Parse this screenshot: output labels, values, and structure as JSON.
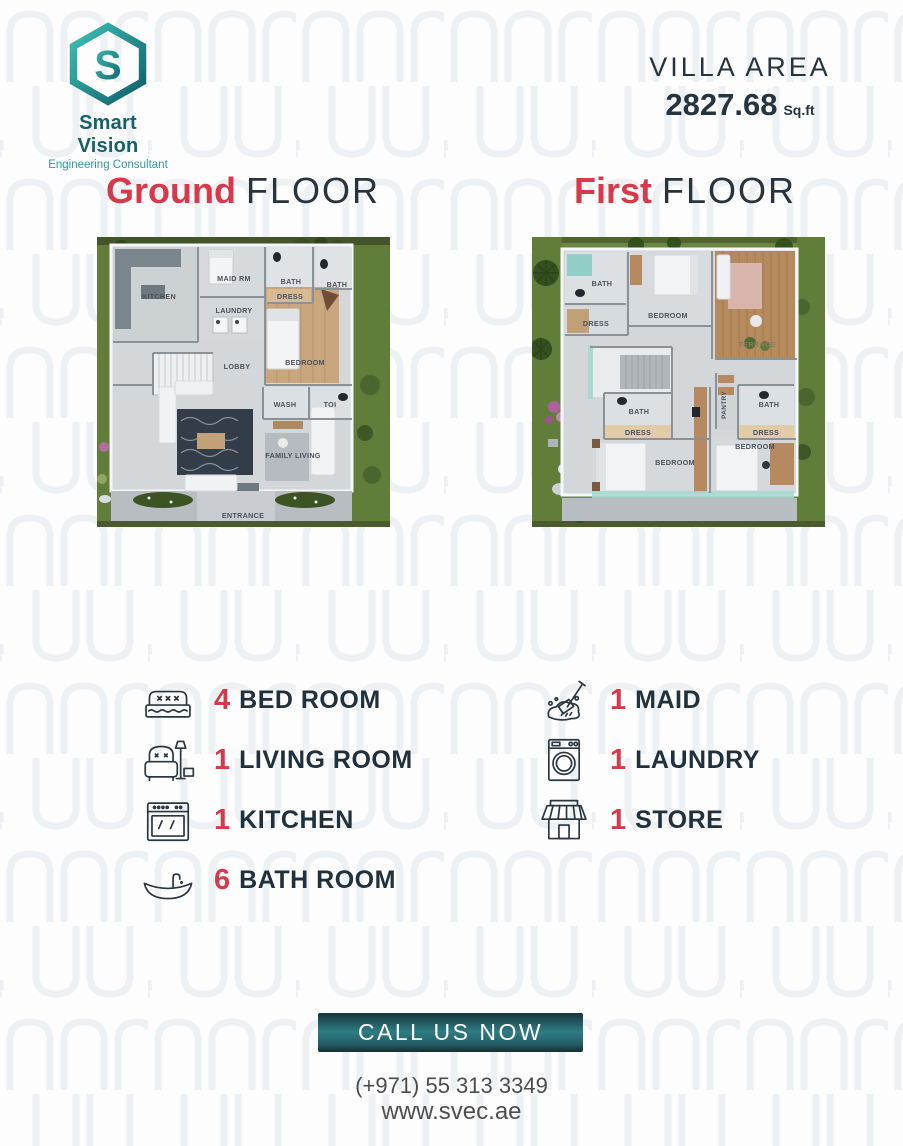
{
  "brand": {
    "name": "Smart Vision",
    "tagline": "Engineering Consultant",
    "mark_letter": "S"
  },
  "villa_area": {
    "label": "VILLA AREA",
    "value": "2827.68",
    "unit": "Sq.ft"
  },
  "floors": {
    "ground": {
      "title_accent": "Ground",
      "title_rest": "FLOOR",
      "labels": [
        "KITCHEN",
        "MAID RM",
        "BATH",
        "BATH",
        "DRESS",
        "LAUNDRY",
        "LOBBY",
        "BEDROOM",
        "WASH",
        "TOI",
        "FAMILY LIVING",
        "ENTRANCE"
      ]
    },
    "first": {
      "title_accent": "First",
      "title_rest": "FLOOR",
      "labels": [
        "BATH",
        "BEDROOM",
        "DRESS",
        "TERRACE",
        "BATH",
        "DRESS",
        "BEDROOM",
        "PANTRY",
        "BATH",
        "DRESS",
        "BEDROOM"
      ]
    }
  },
  "amenities": {
    "left": [
      {
        "count": "4",
        "label": "BED ROOM",
        "icon": "bed-icon"
      },
      {
        "count": "1",
        "label": "LIVING ROOM",
        "icon": "armchair-icon"
      },
      {
        "count": "1",
        "label": "KITCHEN",
        "icon": "stove-icon"
      },
      {
        "count": "6",
        "label": "BATH ROOM",
        "icon": "bathtub-icon"
      }
    ],
    "right": [
      {
        "count": "1",
        "label": "MAID",
        "icon": "mop-icon"
      },
      {
        "count": "1",
        "label": "LAUNDRY",
        "icon": "washing-machine-icon"
      },
      {
        "count": "1",
        "label": "STORE",
        "icon": "storefront-icon"
      }
    ]
  },
  "cta": {
    "button_label": "CALL US NOW",
    "phone": "(+971) 55 313 3349",
    "website": "www.svec.ae"
  },
  "colors": {
    "accent_red": "#d7384a",
    "heading_navy": "#27333d",
    "brand_teal_dark": "#0e5f68",
    "brand_teal_light": "#3ec0b4",
    "button_gradient_top": "#16343c",
    "button_gradient_mid": "#2e7c83",
    "button_gradient_bottom": "#132e35",
    "contact_gray": "#4c4c4c"
  }
}
